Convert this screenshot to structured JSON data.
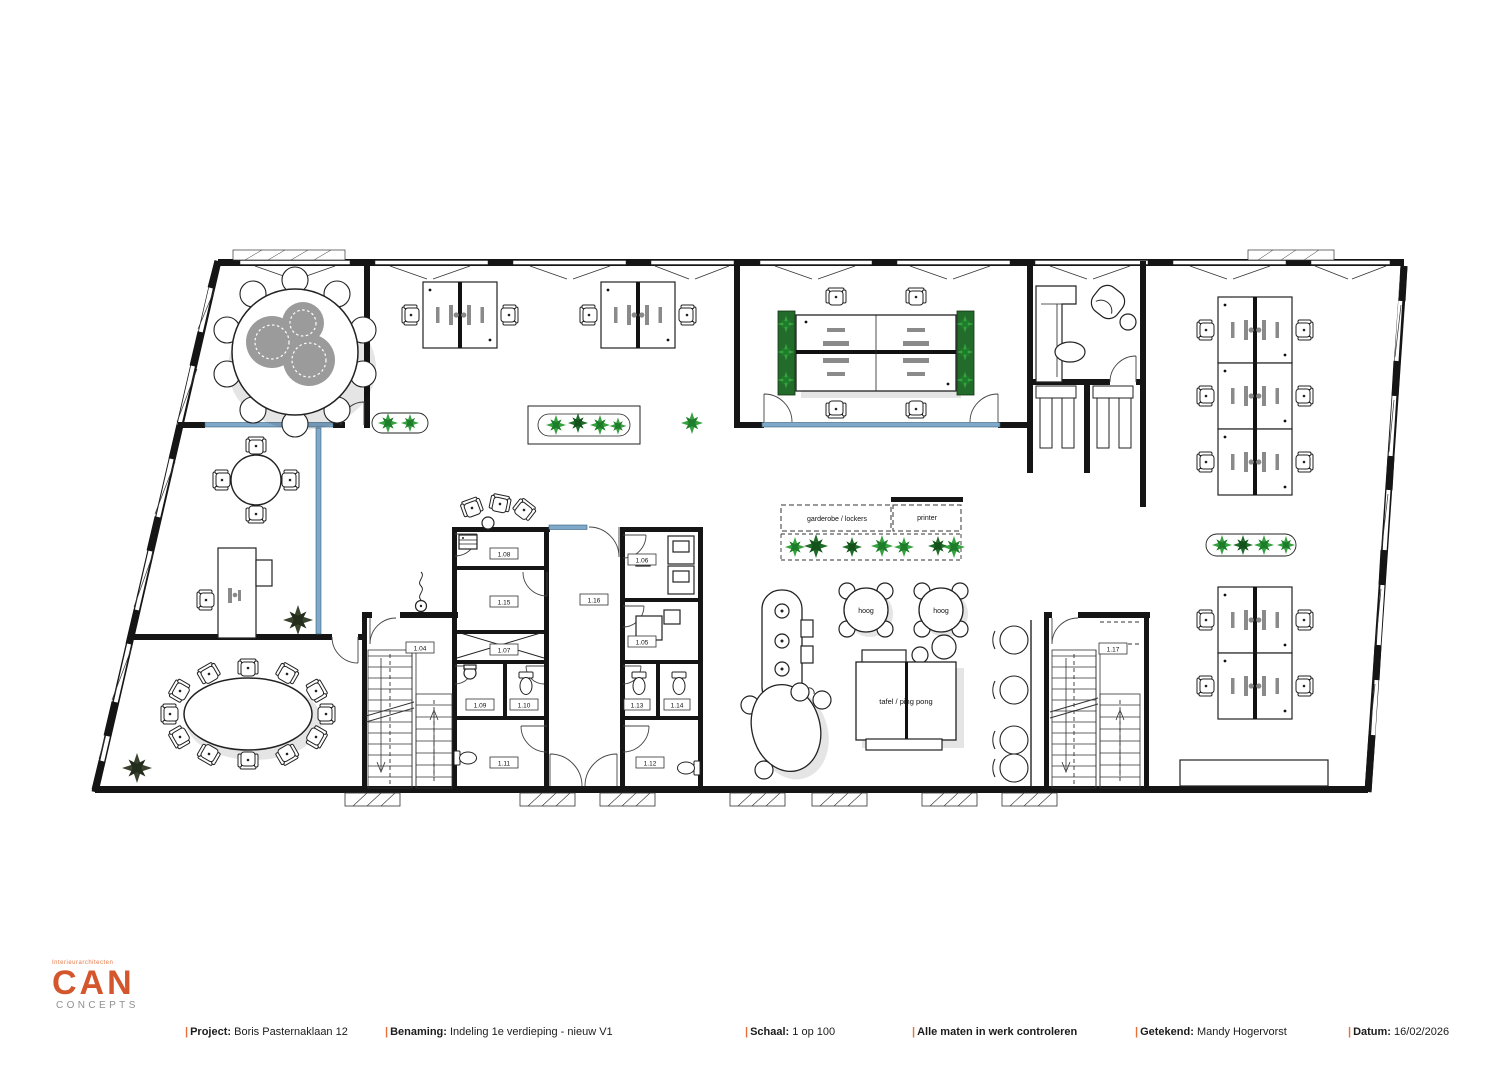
{
  "logo": {
    "tagline": "Interieurarchitecten",
    "name": "CAN",
    "subtitle": "CONCEPTS"
  },
  "title_block": {
    "project_label": "Project:",
    "project_value": "Boris Pasternaklaan 12",
    "benaming_label": "Benaming:",
    "benaming_value": "Indeling 1e verdieping - nieuw V1",
    "schaal_label": "Schaal:",
    "schaal_value": "1 op 100",
    "note": "Alle maten in werk controleren",
    "getekend_label": "Getekend:",
    "getekend_value": "Mandy Hogervorst",
    "datum_label": "Datum:",
    "datum_value": "16/02/2026"
  },
  "plan": {
    "labels": {
      "garderobe": "garderobe / lockers",
      "printer": "printer",
      "hoog": "hoog",
      "ping_pong": "tafel / ping pong"
    },
    "rooms": {
      "r104": "1.04",
      "r105": "1.05",
      "r106": "1.06",
      "r107": "1.07",
      "r108": "1.08",
      "r109": "1.09",
      "r110": "1.10",
      "r111": "1.11",
      "r112": "1.12",
      "r113": "1.13",
      "r114": "1.14",
      "r115": "1.15",
      "r116": "1.16",
      "r117": "1.17"
    },
    "colors": {
      "glass": "#7fa8c9",
      "plant_light": "#35a03e",
      "plant_dark": "#1e6b28",
      "accent_orange": "#e8703a"
    }
  }
}
